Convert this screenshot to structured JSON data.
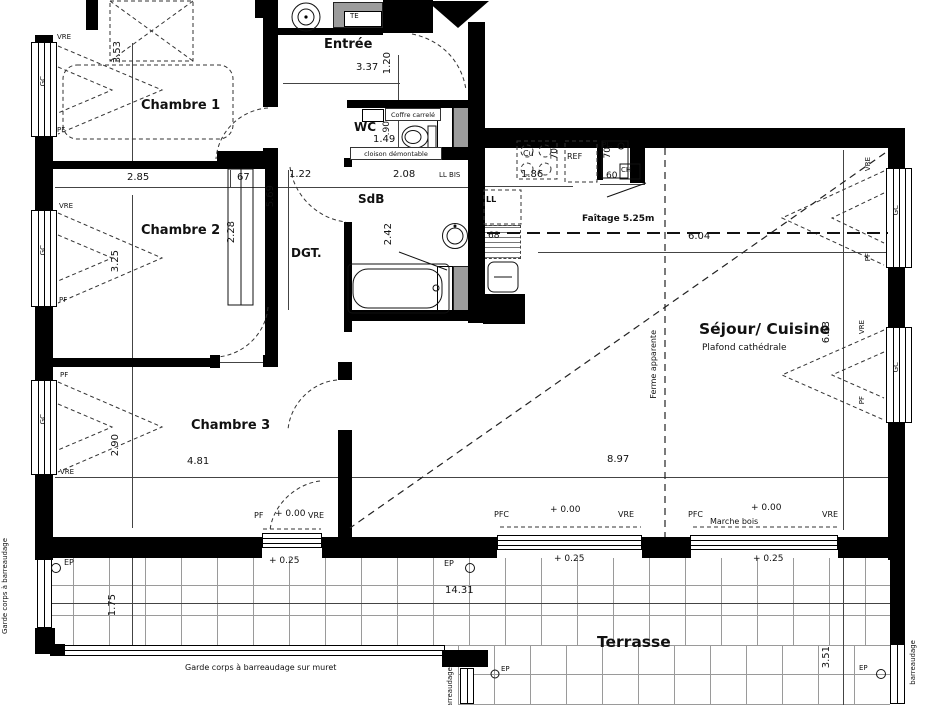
{
  "title": "Plan d'appartement",
  "colors": {
    "wall": "#000000",
    "duct_gray": "#9c9c9c",
    "grid_line": "#9a9a9a",
    "background": "#ffffff"
  },
  "rooms": {
    "chambre1": "Chambre 1",
    "chambre2": "Chambre 2",
    "chambre3": "Chambre 3",
    "entree": "Entrée",
    "wc": "WC",
    "sdb": "SdB",
    "dgt": "DGT.",
    "sejour": "Séjour/ Cuisine",
    "sejour_note": "Plafond cathédrale",
    "terrasse": "Terrasse"
  },
  "annotations": {
    "coffre": "Coffre carrelé",
    "cloison": "cloison démontable",
    "ferme": "Ferme apparente",
    "faitage": "Faîtage 5.25m",
    "marche": "Marche bois",
    "te": "TE",
    "garde_left": "Garde corps à barreaudage",
    "garde_muret": "Garde corps à barreaudage sur muret",
    "barreaudage": "barreaudage",
    "ep": "EP",
    "ll": "LL",
    "ll_bis": "LL BIS",
    "cu": "Cu",
    "ref": "REF",
    "pl": "PL.",
    "ch": "CH"
  },
  "levels": {
    "zero": "+ 0.00",
    "plus25": "+ 0.25"
  },
  "window_labels": {
    "vre": "VRE",
    "pf": "PF",
    "pfc": "PFC",
    "gc": "GC"
  },
  "dimensions": {
    "d353": "3.53",
    "d285": "2.85",
    "d67": "67",
    "d569": "5.69",
    "d337": "3.37",
    "d120": "1.20",
    "d122": "1.22",
    "d208": "2.08",
    "d149": "1.49",
    "d90": ".90",
    "d186": "1.86",
    "d70": "70",
    "d60": "60",
    "d68": "68",
    "d228": "2.28",
    "d325": "3.25",
    "d242": "2.42",
    "d604": "6.04",
    "d663": "6.63",
    "d290": "2.90",
    "d481": "4.81",
    "d897": "8.97",
    "d1431": "14.31",
    "d175": "1.75",
    "d351": "3.51"
  }
}
